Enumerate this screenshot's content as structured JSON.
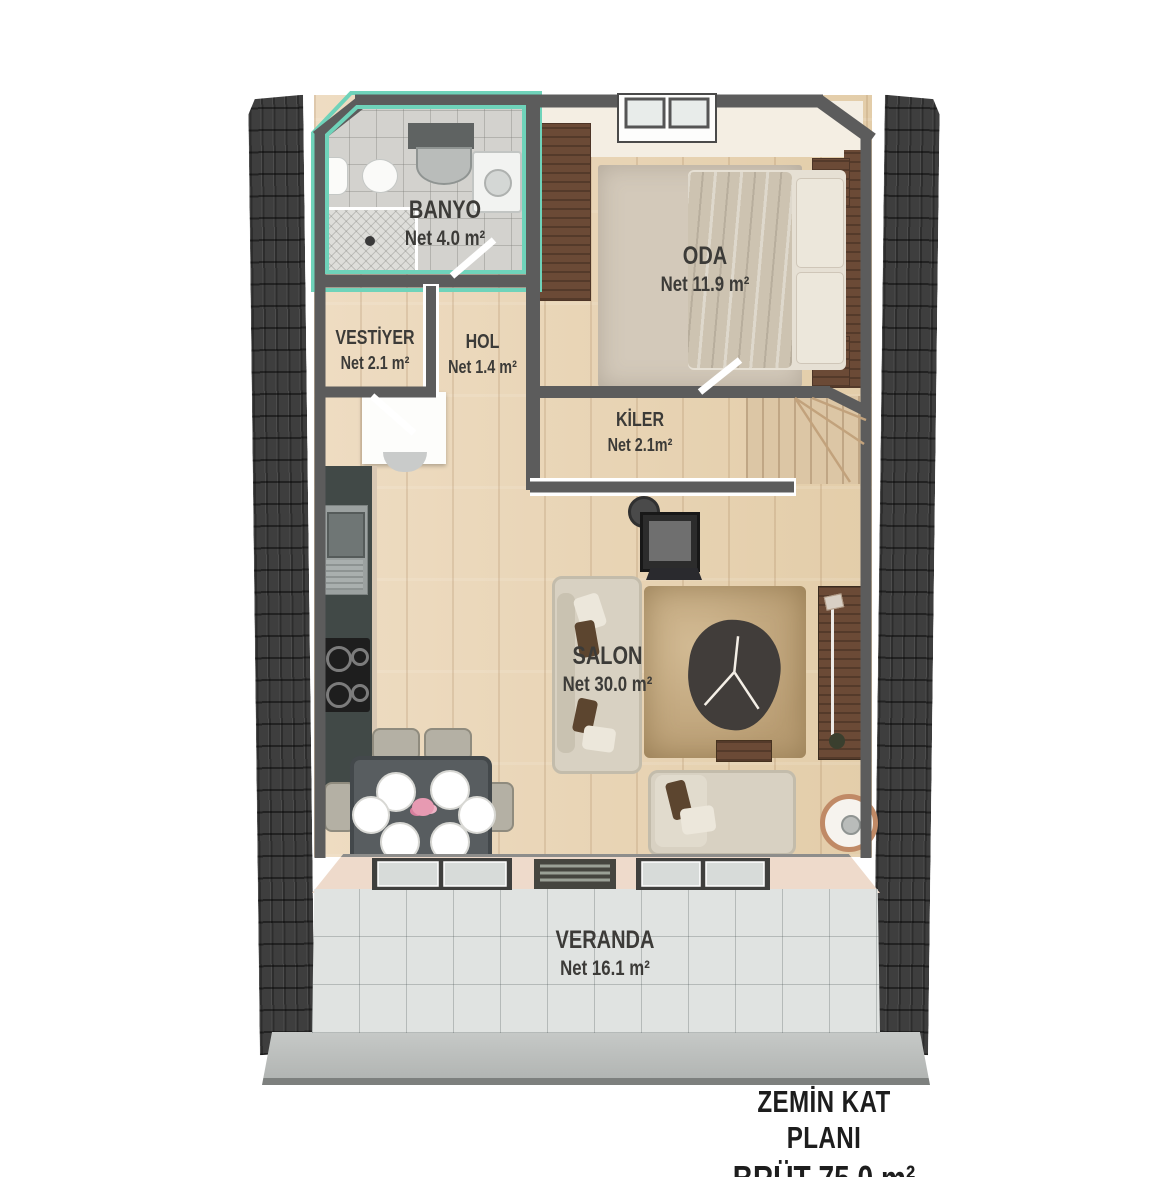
{
  "title": "Zemin kat plani — floor plan",
  "rooms": [
    {
      "id": "banyo",
      "name": "BANYO",
      "area": "Net 4.0 m²"
    },
    {
      "id": "oda",
      "name": "ODA",
      "area": "Net 11.9 m²"
    },
    {
      "id": "vestiyer",
      "name": "VESTİYER",
      "area": "Net 2.1 m²"
    },
    {
      "id": "hol",
      "name": "HOL",
      "area": "Net 1.4 m²"
    },
    {
      "id": "kiler",
      "name": "KİLER",
      "area": "Net 2.1m²"
    },
    {
      "id": "salon",
      "name": "SALON",
      "area": "Net 30.0 m²"
    },
    {
      "id": "veranda",
      "name": "VERANDA",
      "area": "Net 16.1 m²"
    }
  ],
  "footer": {
    "line1": "ZEMİN KAT PLANI",
    "line2": "BRÜT 75.0 m²"
  },
  "colors": {
    "accent_mint": "#6fd3ba",
    "wall_gray": "#5c5c5c",
    "facade_panel": "#3e3e3e",
    "label_text": "#3c3b38",
    "footer_text": "#1d1d1d",
    "wood_floor": "#e9d6ba",
    "veranda_tile": "#e0e3e1"
  }
}
